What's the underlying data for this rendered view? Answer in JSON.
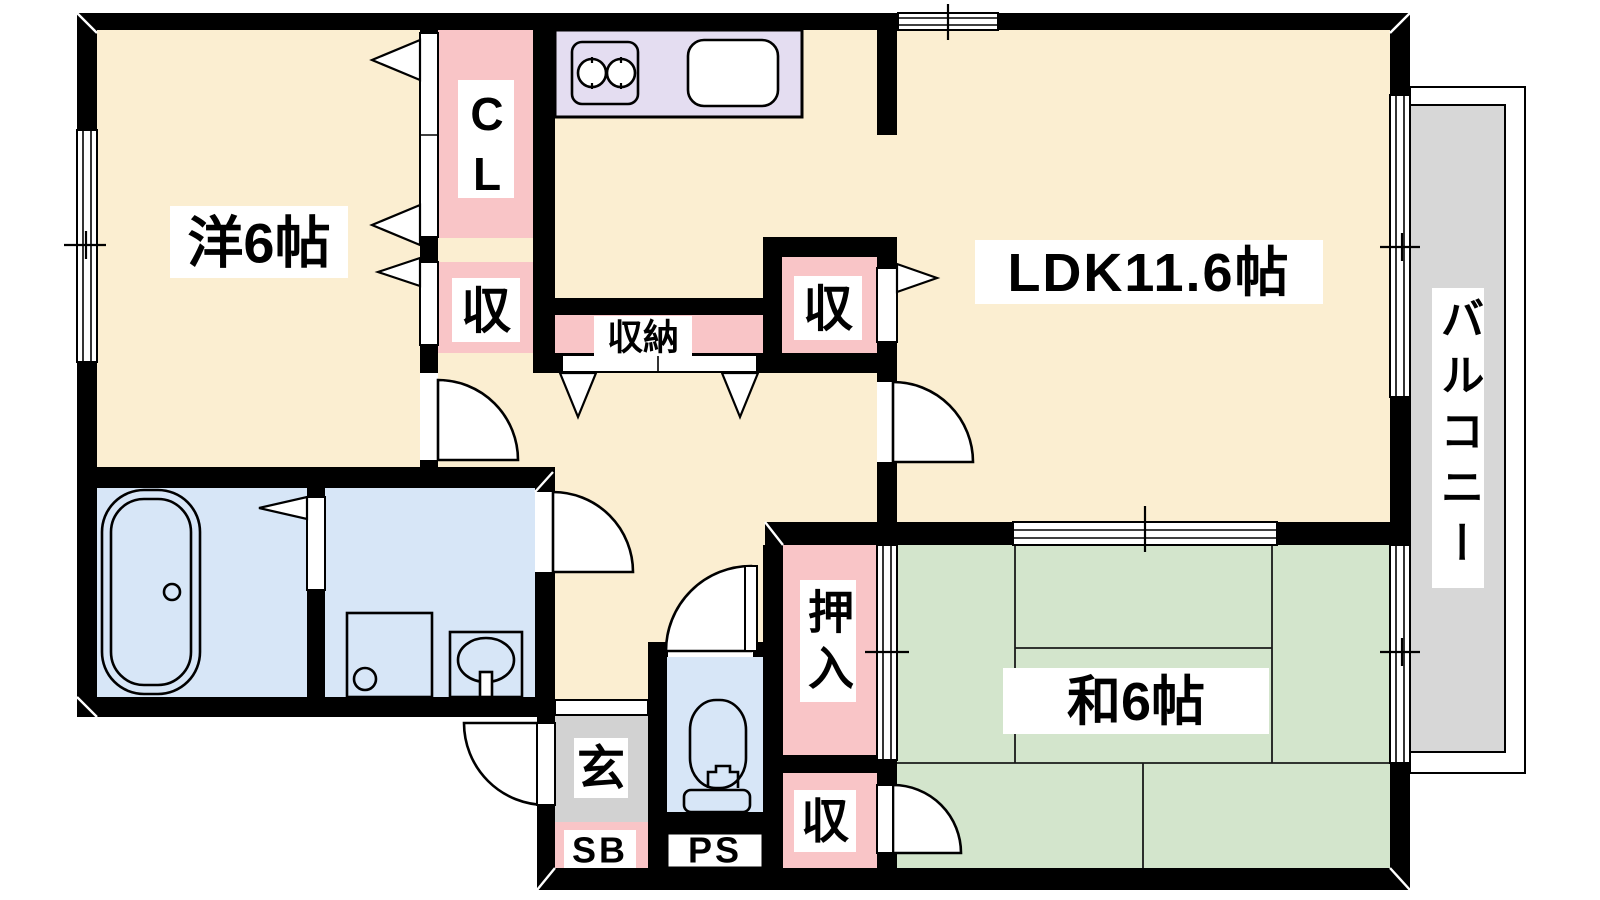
{
  "colors": {
    "wall": "#000000",
    "floor": "#FBEED1",
    "tatami": "#D3E5CC",
    "wet_area": "#D7E6F7",
    "storage": "#F9C5C7",
    "kitchen_counter": "#E4DDF1",
    "genkan": "#D2D2D2",
    "balcony": "#D7D7D7",
    "outline": "#000000"
  },
  "rooms": {
    "western": {
      "label": "洋6帖"
    },
    "ldk": {
      "label": "LDK11.6帖"
    },
    "japanese": {
      "label": "和6帖"
    },
    "balcony": {
      "label": "バルコニー"
    },
    "closet": {
      "label": "CL"
    },
    "storage_west": {
      "label": "収"
    },
    "storage_hall": {
      "label": "収納"
    },
    "storage_ldk": {
      "label": "収"
    },
    "oshiire": {
      "label": "押入"
    },
    "storage_tatami": {
      "label": "収"
    },
    "entrance": {
      "label": "玄"
    },
    "shoe_box": {
      "label": "SB"
    },
    "pipe_space": {
      "label": "PS"
    }
  }
}
